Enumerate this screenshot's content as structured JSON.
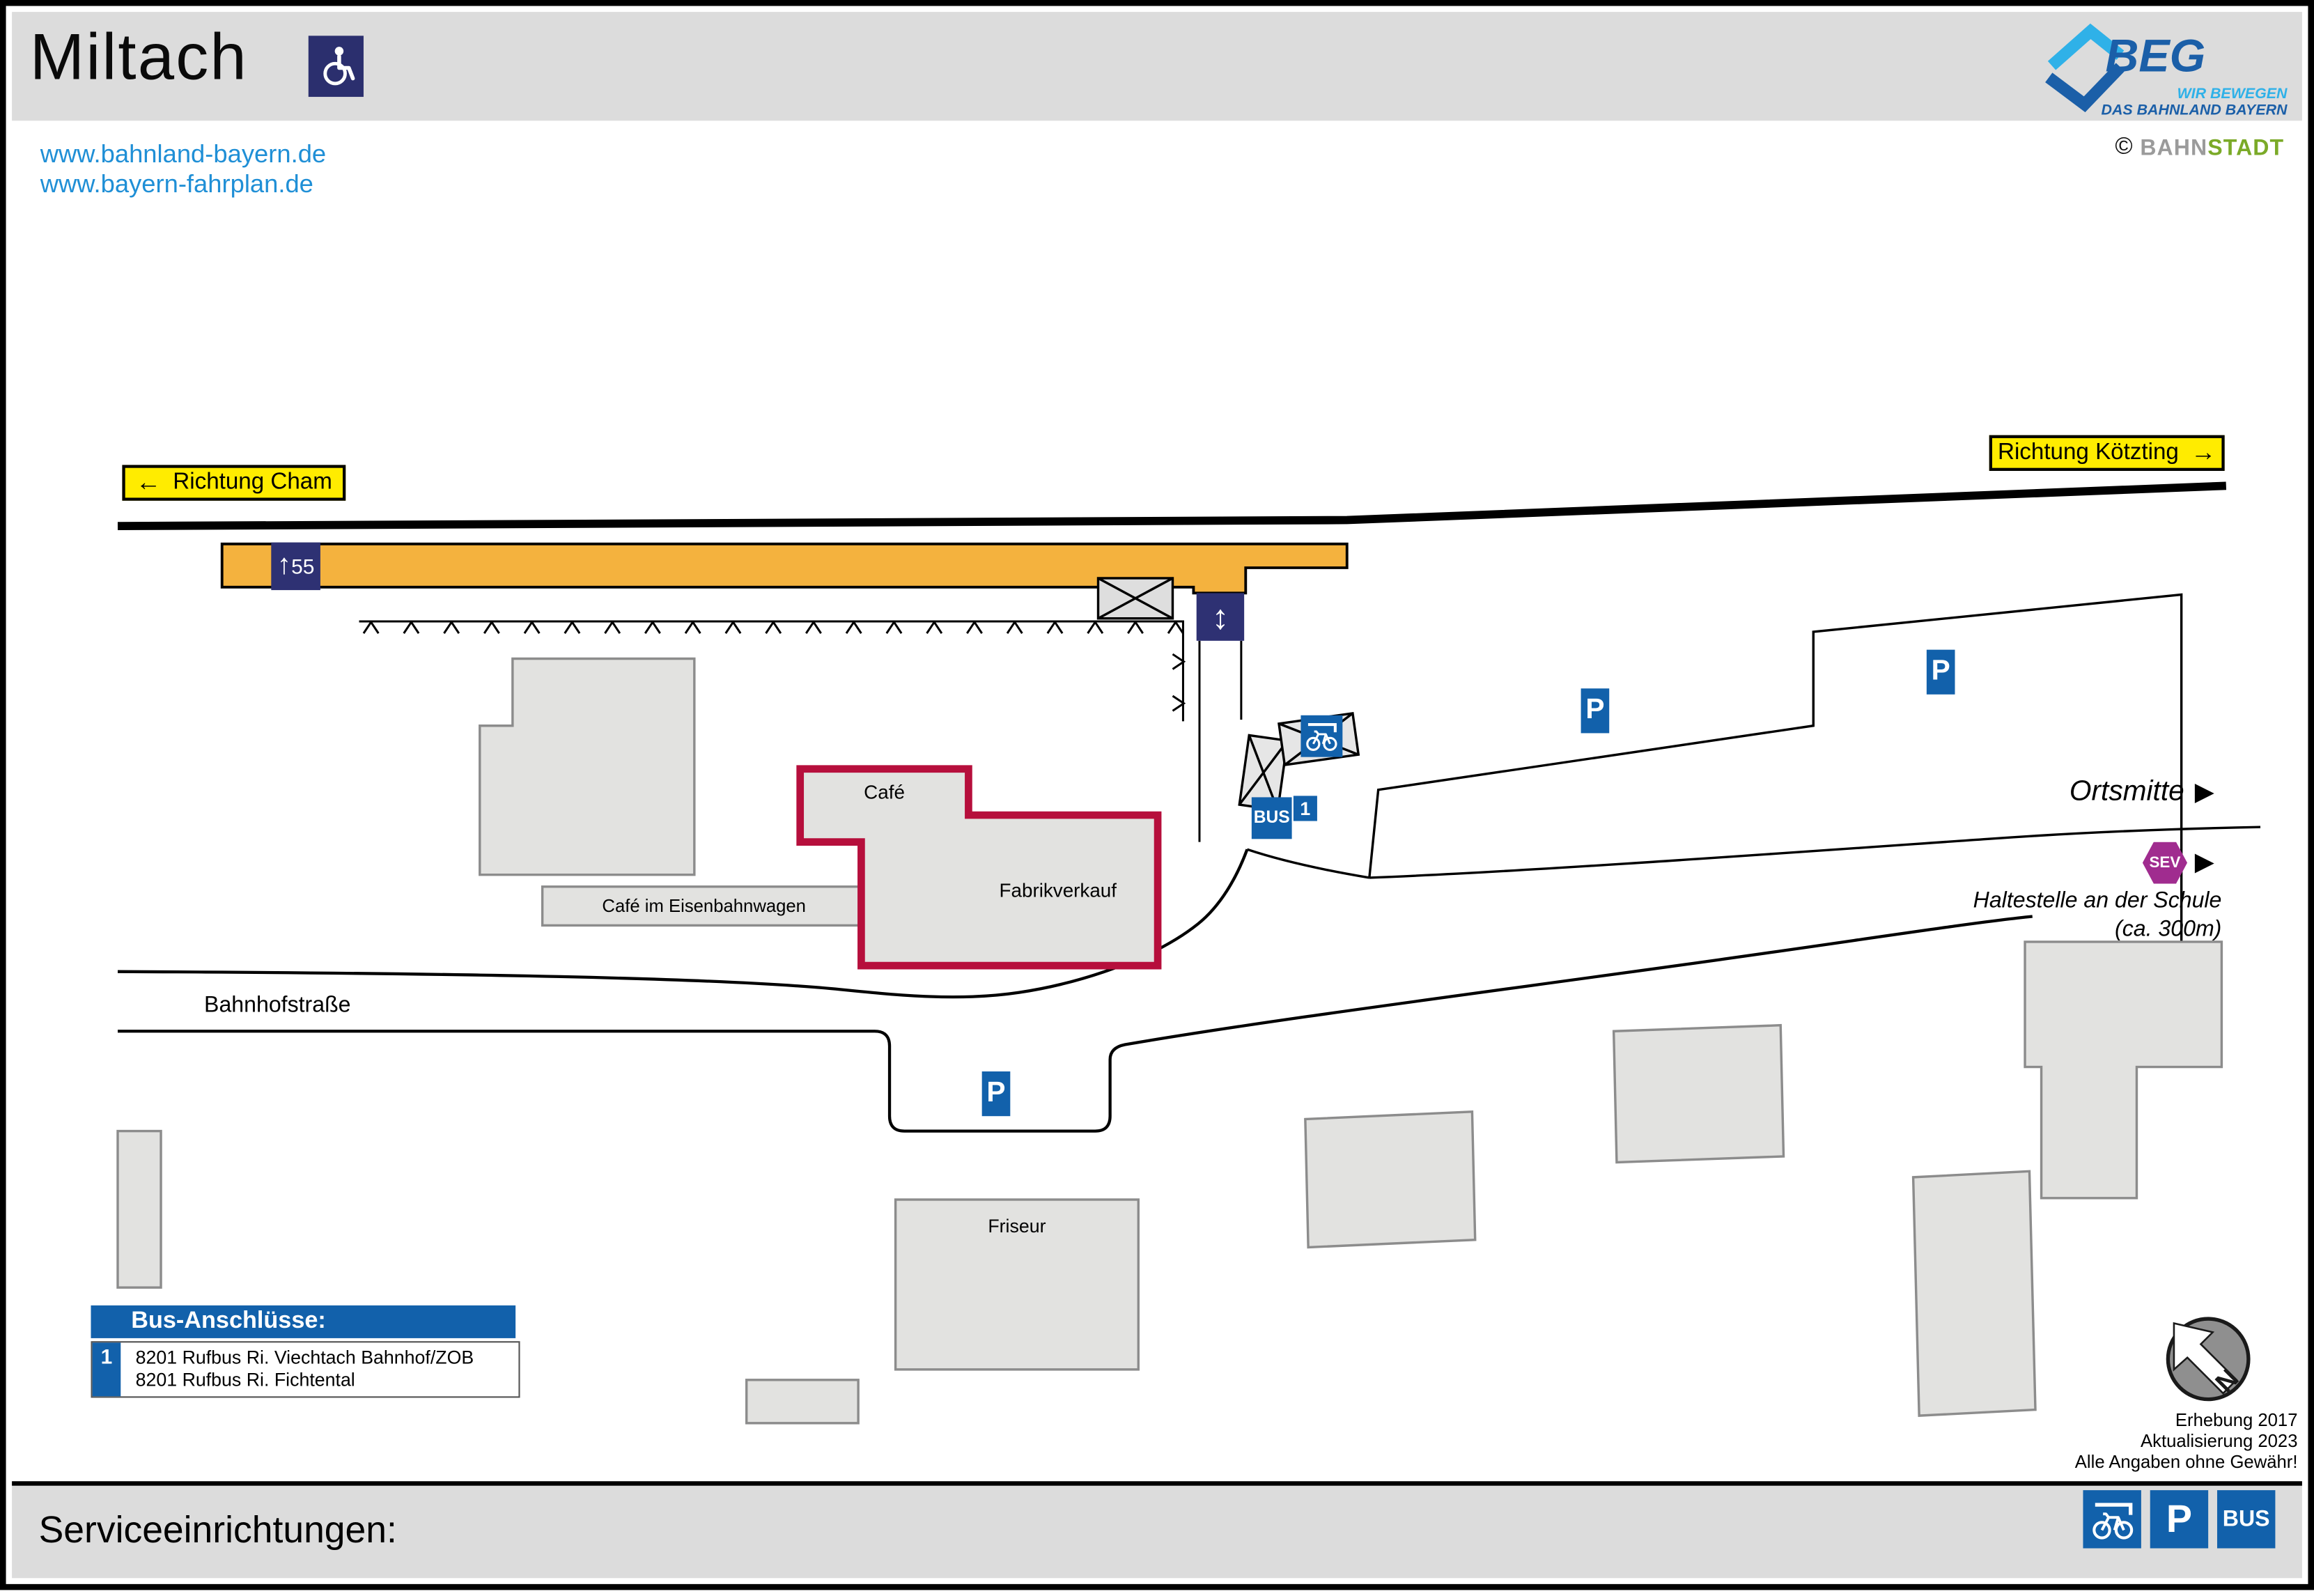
{
  "header": {
    "title": "Miltach",
    "links": [
      "www.bahnland-bayern.de",
      "www.bayern-fahrplan.de"
    ],
    "beg": {
      "name": "BEG",
      "line1": "WIR BEWEGEN",
      "line2": "DAS BAHNLAND BAYERN"
    },
    "credit": {
      "symbol": "©",
      "bahn": "BAHN",
      "stadt": "STADT"
    }
  },
  "map": {
    "signs": {
      "left": {
        "arrow": "←",
        "label": "Richtung Cham"
      },
      "right": {
        "label": "Richtung Kötzting",
        "arrow": "→"
      }
    },
    "platform": {
      "arrow": "↑",
      "height": "55"
    },
    "lift_arrow": "↕",
    "street_label": "Bahnhofstraße",
    "buildings": {
      "cafe": "Café",
      "factory_outlet": "Fabrikverkauf",
      "railcar_cafe": "Café im Eisenbahnwagen",
      "hairdresser": "Friseur"
    },
    "poi": {
      "parking": "P",
      "bus": "BUS",
      "stop_no": "1",
      "sev": "SEV",
      "arrow_right": "▶",
      "ortsmitte": "Ortsmitte",
      "sev_stop_line1": "Haltestelle an der Schule",
      "sev_stop_line2": "(ca. 300m)"
    },
    "compass_north": "N"
  },
  "legend": {
    "title": "Bus-Anschlüsse:",
    "entries": [
      {
        "id": "1",
        "lines": [
          "8201 Rufbus Ri. Viechtach Bahnhof/ZOB",
          "8201 Rufbus Ri. Fichtental"
        ]
      }
    ]
  },
  "notes": [
    "Erhebung 2017",
    "Aktualisierung 2023",
    "Alle Angaben ohne Gewähr!"
  ],
  "service_bar": {
    "label": "Serviceeinrichtungen:",
    "parking": "P",
    "bus": "BUS"
  },
  "colors": {
    "accent_blue": "#1261ab",
    "platform_orange": "#f4b23e",
    "sign_yellow": "#ffec00",
    "navy": "#2e3173",
    "sev_purple": "#a02c8f",
    "building_outline_red": "#b60f3c",
    "link_blue": "#1f8fd6",
    "beg_dark_blue": "#1b5fa8",
    "beg_light_blue": "#2fb1e8"
  }
}
